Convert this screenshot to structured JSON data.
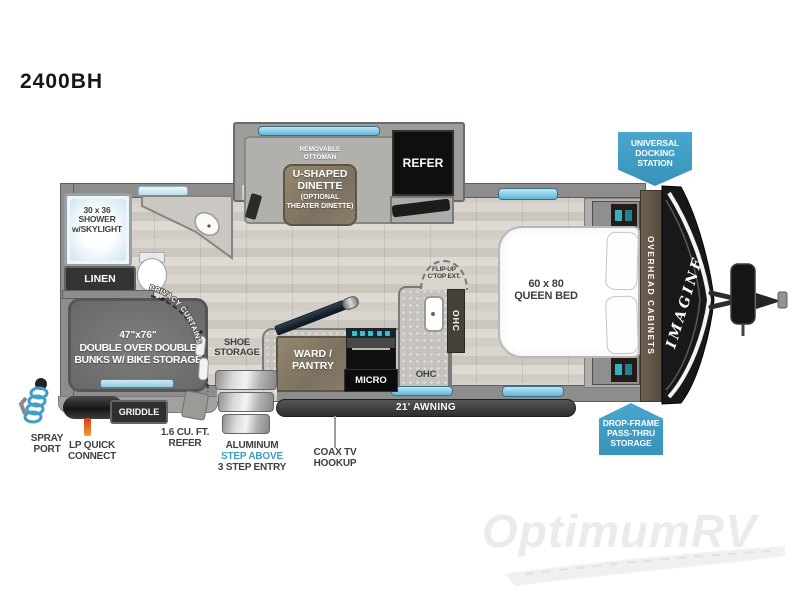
{
  "title": "2400BH",
  "colors": {
    "badge_blue": "#3f9dc5",
    "window_blue": "#72c5e2",
    "accent_teal": "#35c2d4",
    "wall_gray": "#8d8d8d",
    "label_dark": "#3f3f3f"
  },
  "plan": {
    "slide": {
      "ottoman": "REMOVABLE OTTOMAN",
      "dinette_line1": "U-SHAPED",
      "dinette_line2": "DINETTE",
      "dinette_line3": "(OPTIONAL",
      "dinette_line4": "THEATER DINETTE)",
      "refer": "REFER"
    },
    "bath": {
      "shower": "30 x 36 SHOWER w/SKYLIGHT",
      "linen": "LINEN"
    },
    "bunk_room": {
      "bunks_line1": "47\"x76\"",
      "bunks_line2": "DOUBLE OVER DOUBLE",
      "bunks_line3": "BUNKS W/ BIKE STORAGE",
      "privacy_curtains": "PRIVACY CURTAINS"
    },
    "kitchen": {
      "shoe_storage": "SHOE STORAGE",
      "ward_pantry": "WARD / PANTRY",
      "micro": "MICRO",
      "ohc_side": "OHC",
      "ohc_lower": "OHC",
      "flip_up": "FLIP-UP C'TOP EXT."
    },
    "bedroom": {
      "bed": "60 x 80 QUEEN BED",
      "overhead_cabinets": "OVERHEAD CABINETS",
      "brand": "IMAGINE"
    }
  },
  "exterior": {
    "docking_station": "UNIVERSAL DOCKING STATION",
    "drop_frame_storage": "DROP-FRAME PASS-THRU STORAGE",
    "awning": "21' AWNING",
    "spray_port": "SPRAY PORT",
    "lp_quick_connect": "LP QUICK CONNECT",
    "griddle": "GRIDDLE",
    "mini_refer": "1.6 CU. FT. REFER",
    "entry_line1": "ALUMINUM",
    "entry_line2": "STEP ABOVE",
    "entry_line3": "3 STEP ENTRY",
    "coax": "COAX TV HOOKUP"
  },
  "watermark": "OptimumRV"
}
